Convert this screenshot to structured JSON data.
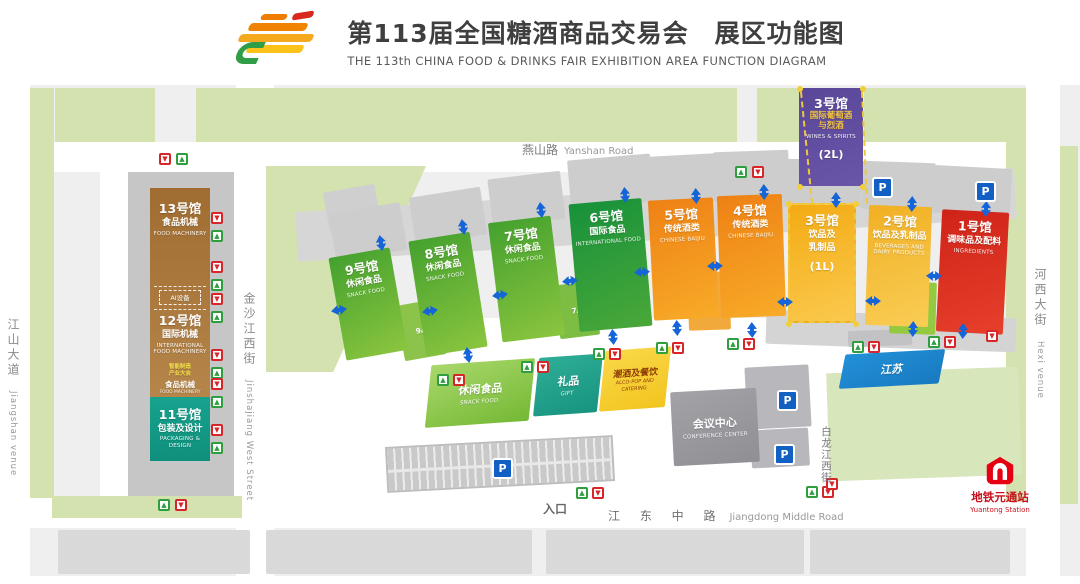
{
  "header": {
    "title_cn": "第113届全国糖酒商品交易会　展区功能图",
    "title_en": "THE 113th CHINA FOOD & DRINKS FAIR EXHIBITION AREA FUNCTION DIAGRAM",
    "logo": "sugar-and-wine-fair-logo"
  },
  "roads": {
    "yanshan": {
      "cn": "燕山路",
      "en": "Yanshan Road"
    },
    "jiangdong": {
      "cn": "江 东 中 路",
      "en": "Jiangdong Middle Road"
    },
    "jiangshan": {
      "cn": "江山大道",
      "en": "Jiangshan venue"
    },
    "jinshajiang": {
      "cn": "金沙江西街",
      "en": "Jinshajiang West Street"
    },
    "bailongjiang": {
      "cn": "白龙江西街"
    },
    "hexi": {
      "cn": "河西大街",
      "en": "Hexi venue"
    }
  },
  "entrance_label": "入口",
  "metro": {
    "cn": "地铁元通站",
    "en": "Yuantong Station",
    "color": "#c8101c"
  },
  "left_building": {
    "h13": {
      "num": "13号馆",
      "cn": "食品机械",
      "en": "FOOD MACHINERY"
    },
    "ai_box": "AI设备",
    "h12": {
      "num": "12号馆",
      "cn": "国际机械",
      "en": "INTERNATIONAL FOOD MACHINERY"
    },
    "sub": {
      "l1": "智能制造",
      "l2": "产业大会",
      "cn": "食品机械",
      "en": "FOOD MACHINERY"
    },
    "h11": {
      "num": "11号馆",
      "cn": "包装及设计",
      "en": "PACKAGING & DESIGN"
    }
  },
  "map": {
    "bg": "#efefef",
    "green": "#d3e2ae",
    "whites": [
      [
        0,
        85,
        30,
        499
      ],
      [
        236,
        85,
        38,
        499
      ],
      [
        1026,
        85,
        34,
        499
      ],
      [
        30,
        142,
        1000,
        30
      ],
      [
        30,
        496,
        1000,
        32
      ],
      [
        274,
        318,
        752,
        180
      ],
      [
        812,
        424,
        32,
        74
      ],
      [
        0,
        576,
        1080,
        8
      ]
    ],
    "greens": [
      [
        55,
        88,
        100,
        54
      ],
      [
        196,
        88,
        541,
        54
      ],
      [
        757,
        88,
        43,
        54
      ],
      [
        864,
        88,
        142,
        54
      ],
      [
        30,
        88,
        24,
        410
      ],
      [
        1006,
        88,
        20,
        414
      ],
      [
        1060,
        146,
        18,
        358
      ],
      [
        52,
        496,
        190,
        22
      ],
      [
        274,
        166,
        12,
        200
      ]
    ],
    "field": {
      "x": 266,
      "y": 166,
      "w": 160,
      "h": 206,
      "clip": "polygon(0 0,100% 0,42% 100%,0 100%)"
    },
    "lawn": [
      828,
      370,
      192,
      108,
      -2,
      "#d8e6bc"
    ],
    "greys": [
      [
        296,
        190,
        720,
        50,
        -3.5,
        "#d6d6d6"
      ],
      [
        326,
        188,
        52,
        40,
        -10,
        "#cfcfcf"
      ],
      [
        766,
        314,
        250,
        34,
        2,
        "#d4d4d4"
      ],
      [
        848,
        330,
        64,
        16,
        -2,
        "#c2c2c4"
      ],
      [
        746,
        366,
        64,
        62,
        -3,
        "#b7b7bc"
      ],
      [
        751,
        429,
        58,
        38,
        -3,
        "#b7b7bc"
      ],
      [
        862,
        174,
        40,
        18,
        0,
        "#c9c9c9"
      ],
      [
        964,
        178,
        40,
        18,
        0,
        "#c9c9c9"
      ],
      [
        58,
        530,
        192,
        44,
        0,
        "#d9d9d9"
      ],
      [
        266,
        530,
        266,
        44,
        0,
        "#d9d9d9"
      ],
      [
        546,
        530,
        258,
        44,
        0,
        "#d9d9d9"
      ],
      [
        810,
        530,
        200,
        44,
        0,
        "#d9d9d9"
      ]
    ],
    "parking_strip": [
      386,
      441,
      228,
      46,
      -3
    ],
    "halls": [
      {
        "id": "hall-9",
        "x": 337,
        "y": 252,
        "w": 62,
        "h": 104,
        "rot": -10,
        "c1": "#44a12e",
        "c2": "#8bc53f",
        "pad": true,
        "txt": [
          [
            "num",
            "9号馆"
          ],
          [
            "cn",
            "休闲食品"
          ],
          [
            "en",
            "SNACK FOOD"
          ]
        ]
      },
      {
        "id": "hall-8",
        "x": 417,
        "y": 236,
        "w": 62,
        "h": 116,
        "rot": -9,
        "c1": "#44a12e",
        "c2": "#8bc53f",
        "pad": true,
        "txt": [
          [
            "num",
            "8号馆"
          ],
          [
            "cn",
            "休闲食品"
          ],
          [
            "en",
            "SNACK FOOD"
          ]
        ]
      },
      {
        "id": "hall-7",
        "x": 495,
        "y": 219,
        "w": 63,
        "h": 120,
        "rot": -7,
        "c1": "#44a12e",
        "c2": "#8bc53f",
        "pad": true,
        "txt": [
          [
            "num",
            "7号馆"
          ],
          [
            "cn",
            "休闲食品"
          ],
          [
            "en",
            "SNACK FOOD"
          ]
        ]
      },
      {
        "id": "hall-6",
        "x": 574,
        "y": 201,
        "w": 73,
        "h": 128,
        "rot": -5,
        "c1": "#17913a",
        "c2": "#4aa839",
        "pad": true,
        "txt": [
          [
            "num",
            "6号馆"
          ],
          [
            "cn",
            "国际食品"
          ],
          [
            "en",
            "INTERNATIONAL FOOD"
          ]
        ]
      },
      {
        "id": "hall-5",
        "x": 651,
        "y": 199,
        "w": 65,
        "h": 120,
        "rot": -3,
        "c1": "#ee8115",
        "c2": "#f8ab28",
        "pad": true,
        "txt": [
          [
            "num",
            "5号馆"
          ],
          [
            "cn",
            "传统酒类"
          ],
          [
            "en",
            "CHINESE BAIJIU"
          ]
        ]
      },
      {
        "id": "hall-4",
        "x": 719,
        "y": 195,
        "w": 65,
        "h": 122,
        "rot": -2,
        "c1": "#ee8115",
        "c2": "#f8ab28",
        "pad": true,
        "txt": [
          [
            "num",
            "4号馆"
          ],
          [
            "cn",
            "传统酒类"
          ],
          [
            "en",
            "CHINESE BAIJIU"
          ]
        ]
      },
      {
        "id": "hall-3-1l",
        "x": 788,
        "y": 203,
        "w": 68,
        "h": 120,
        "rot": 0,
        "c1": "#f3ab13",
        "c2": "#fbc94e",
        "pad": true,
        "dashed": true,
        "txt": [
          [
            "num",
            "3号馆"
          ],
          [
            "cn",
            "饮品及"
          ],
          [
            "cn",
            "乳制品"
          ],
          [
            "extra",
            "(1L)"
          ]
        ]
      },
      {
        "id": "hall-2",
        "x": 867,
        "y": 206,
        "w": 63,
        "h": 120,
        "rot": 2,
        "c1": "#f1b024",
        "c2": "#f9cd55",
        "pad": true,
        "txt": [
          [
            "num",
            "2号馆"
          ],
          [
            "cn",
            "饮品及乳制品"
          ],
          [
            "en",
            "BEVERAGES AND DAIRY PRODUCTS"
          ]
        ]
      },
      {
        "id": "hall-1",
        "x": 939,
        "y": 211,
        "w": 67,
        "h": 122,
        "rot": 3,
        "c1": "#cf2318",
        "c2": "#e6402c",
        "pad": true,
        "txt": [
          [
            "num",
            "1号馆"
          ],
          [
            "cn",
            "调味品及配料"
          ],
          [
            "en",
            "INGREDIENTS"
          ]
        ]
      },
      {
        "id": "hall-3-2l",
        "x": 799,
        "y": 88,
        "w": 64,
        "h": 98,
        "rot": 0,
        "c1": "#5a4798",
        "c2": "#6a55a8",
        "pad": false,
        "txt": [
          [
            "num",
            "3号馆"
          ],
          [
            "gold",
            "国际葡萄酒"
          ],
          [
            "gold",
            "与烈酒"
          ],
          [
            "en",
            "WINES & SPIRITS"
          ],
          [
            "extra",
            "(2L)"
          ]
        ]
      }
    ],
    "annexes": [
      {
        "id": "annex-9a",
        "label": "9A",
        "x": 400,
        "y": 302,
        "w": 42,
        "h": 56,
        "rot": -10,
        "c": "#8cc34a"
      },
      {
        "id": "annex-7a",
        "label": "7A",
        "x": 557,
        "y": 283,
        "w": 40,
        "h": 54,
        "rot": -7,
        "c": "#7dbd43"
      },
      {
        "id": "annex-5a",
        "label": "5A",
        "x": 688,
        "y": 272,
        "w": 42,
        "h": 58,
        "rot": -2,
        "c": "#f2a93c"
      },
      {
        "id": "annex-2a",
        "label": "2A",
        "x": 890,
        "y": 282,
        "w": 46,
        "h": 52,
        "rot": 2,
        "c": "#95c93f",
        "cn": "绿色农业",
        "en": "GREEN AGRICULTURE"
      }
    ],
    "lower": [
      {
        "id": "snack-food-annex",
        "x": 428,
        "y": 362,
        "w": 104,
        "h": 62,
        "rot": -4,
        "skew": -10,
        "c1": "#a9d76b",
        "c2": "#74b934",
        "txt": [
          [
            "cn2",
            "休闲食品"
          ],
          [
            "en",
            "SNACK FOOD"
          ]
        ]
      },
      {
        "id": "gift-annex",
        "x": 536,
        "y": 356,
        "w": 64,
        "h": 58,
        "rot": -4,
        "skew": -10,
        "c1": "#2fae97",
        "c2": "#17937f",
        "txt": [
          [
            "cn2",
            "礼品"
          ],
          [
            "en",
            "GIFT"
          ]
        ]
      },
      {
        "id": "alco-pop-catering",
        "x": 602,
        "y": 349,
        "w": 66,
        "h": 60,
        "rot": -4,
        "skew": -10,
        "c1": "#f9d84a",
        "c2": "#f2c51f",
        "txt": [
          [
            "cnd",
            "潮酒及餐饮"
          ],
          [
            "end",
            "ALCO-POP AND CATERING"
          ]
        ]
      },
      {
        "id": "conference-center",
        "x": 672,
        "y": 390,
        "w": 86,
        "h": 74,
        "rot": -3,
        "skew": 0,
        "c1": "#a2a2a7",
        "c2": "#8f8f94",
        "txt": [
          [
            "cn2",
            "会议中心"
          ],
          [
            "en",
            "CONFERENCE CENTER"
          ]
        ]
      },
      {
        "id": "jiangsu-building",
        "x": 842,
        "y": 352,
        "w": 100,
        "h": 34,
        "rot": -3,
        "skew": -14,
        "c1": "#2290d8",
        "c2": "#187ac0",
        "txt": [
          [
            "cn2",
            "江苏"
          ]
        ]
      }
    ],
    "gates": [
      [
        "r",
        159,
        153
      ],
      [
        "g",
        176,
        153
      ],
      [
        "g",
        735,
        166
      ],
      [
        "r",
        752,
        166
      ],
      [
        "r",
        211,
        212
      ],
      [
        "g",
        211,
        230
      ],
      [
        "r",
        211,
        261
      ],
      [
        "g",
        211,
        279
      ],
      [
        "r",
        211,
        293
      ],
      [
        "g",
        211,
        311
      ],
      [
        "r",
        211,
        349
      ],
      [
        "g",
        211,
        367
      ],
      [
        "r",
        211,
        378
      ],
      [
        "g",
        211,
        396
      ],
      [
        "r",
        211,
        424
      ],
      [
        "g",
        211,
        442
      ],
      [
        "g",
        437,
        374
      ],
      [
        "r",
        453,
        374
      ],
      [
        "g",
        521,
        361
      ],
      [
        "r",
        537,
        361
      ],
      [
        "g",
        593,
        348
      ],
      [
        "r",
        609,
        348
      ],
      [
        "g",
        656,
        342
      ],
      [
        "r",
        672,
        342
      ],
      [
        "g",
        727,
        338
      ],
      [
        "r",
        743,
        338
      ],
      [
        "g",
        852,
        341
      ],
      [
        "r",
        868,
        341
      ],
      [
        "g",
        928,
        336
      ],
      [
        "r",
        944,
        336
      ],
      [
        "g",
        576,
        487
      ],
      [
        "r",
        592,
        487
      ],
      [
        "g",
        806,
        486
      ],
      [
        "r",
        822,
        486
      ],
      [
        "g",
        158,
        499
      ],
      [
        "r",
        175,
        499
      ],
      [
        "r",
        986,
        330
      ],
      [
        "r",
        826,
        478
      ]
    ],
    "arrows_h": [
      [
        326,
        305,
        -10
      ],
      [
        417,
        306,
        -10
      ],
      [
        487,
        290,
        -8
      ],
      [
        557,
        276,
        -6
      ],
      [
        629,
        267,
        -4
      ],
      [
        702,
        261,
        -2
      ],
      [
        772,
        297,
        0
      ],
      [
        860,
        296,
        1
      ],
      [
        921,
        271,
        2
      ]
    ],
    "arrows_v": [
      [
        368,
        238,
        -10
      ],
      [
        450,
        222,
        -9
      ],
      [
        528,
        205,
        -7
      ],
      [
        612,
        190,
        -5
      ],
      [
        683,
        191,
        -3
      ],
      [
        751,
        187,
        -2
      ],
      [
        823,
        195,
        0
      ],
      [
        899,
        199,
        2
      ],
      [
        973,
        204,
        3
      ],
      [
        455,
        350,
        -9
      ],
      [
        600,
        332,
        -5
      ],
      [
        664,
        323,
        -3
      ],
      [
        739,
        325,
        -2
      ],
      [
        900,
        324,
        2
      ],
      [
        950,
        326,
        3
      ]
    ],
    "parking_icons": [
      [
        872,
        177
      ],
      [
        975,
        181
      ],
      [
        777,
        390
      ],
      [
        774,
        444
      ],
      [
        492,
        458
      ]
    ],
    "dash_lines": [
      [
        800,
        92,
        112,
        -5.7
      ],
      [
        861,
        92,
        112,
        -2.6
      ]
    ],
    "dash_dots": [
      [
        797,
        86
      ],
      [
        860,
        86
      ],
      [
        797,
        184
      ],
      [
        860,
        184
      ],
      [
        786,
        201
      ],
      [
        853,
        201
      ],
      [
        786,
        321
      ],
      [
        853,
        321
      ]
    ],
    "accent_colors": {
      "arrow_blue": "#1565d8",
      "gate_green": "#2f9e3f",
      "gate_red": "#d6262a",
      "projection_yellow": "#ecc83f",
      "parking_blue": "#1260c4"
    }
  }
}
